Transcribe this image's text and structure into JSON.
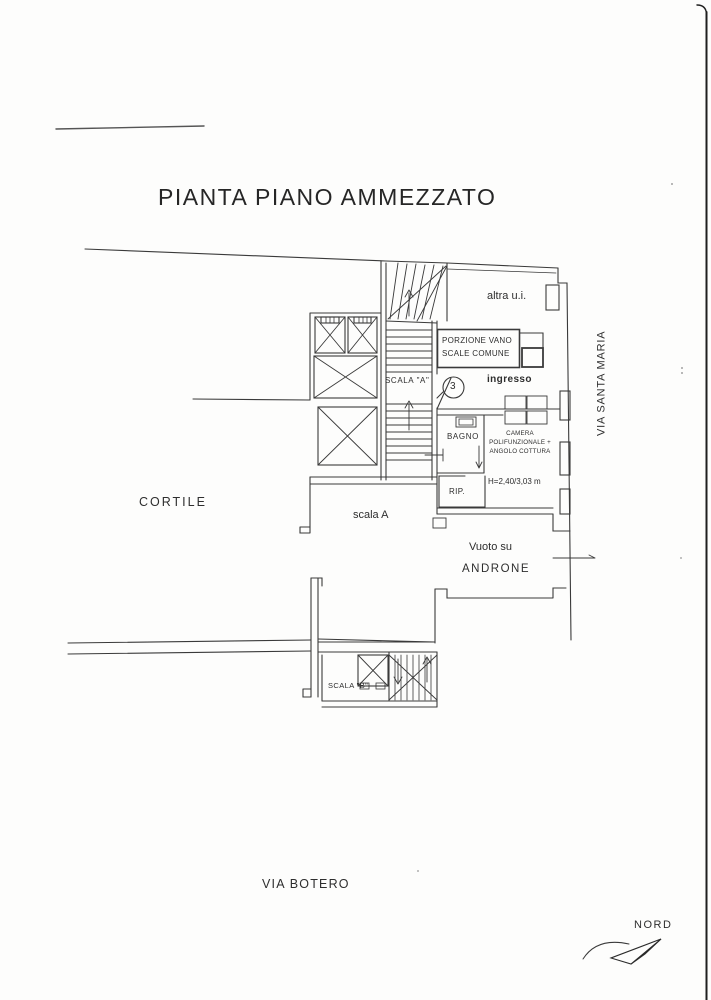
{
  "page": {
    "title": "PIANTA PIANO AMMEZZATO"
  },
  "plan": {
    "labels": {
      "altra_ui": "altra u.i.",
      "porzione_1": "PORZIONE VANO",
      "porzione_2": "SCALE COMUNE",
      "scala_a_shaft": "SCALA \"A\"",
      "unit_number": "3",
      "ingresso": "ingresso",
      "bagno": "BAGNO",
      "camera_1": "CAMERA",
      "camera_2": "POLIFUNZIONALE +",
      "camera_3": "ANGOLO COTTURA",
      "camera_height": "H=2,40/3,03 m",
      "rip": "RIP.",
      "scala_a": "scala A",
      "vuoto_1": "Vuoto su",
      "vuoto_2": "ANDRONE",
      "scala_b": "SCALA \"B\""
    },
    "context": {
      "cortile": "CORTILE",
      "via_santa_maria": "VIA SANTA MARIA",
      "via_botero": "VIA BOTERO",
      "nord": "NORD"
    },
    "ink_color": "#2e2e2e"
  }
}
